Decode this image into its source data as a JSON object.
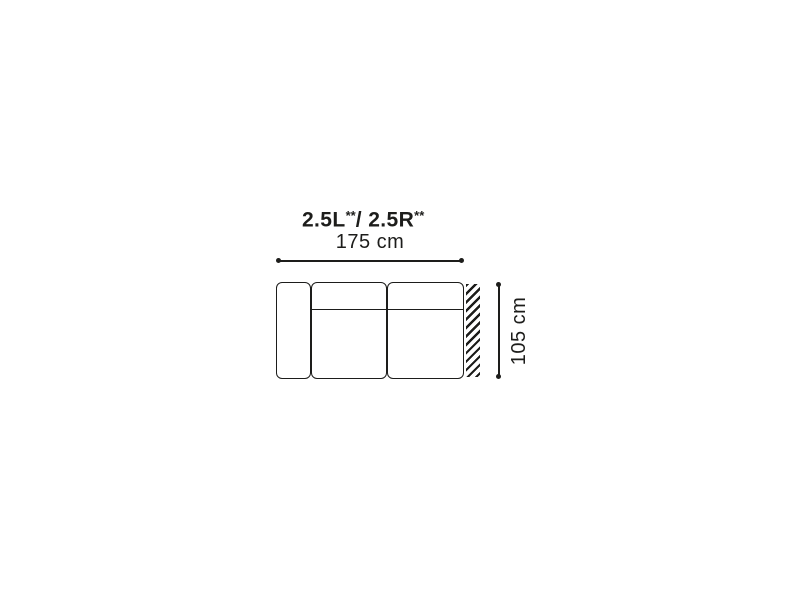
{
  "diagram": {
    "title": {
      "full_text": "2.5L**/ 2.5R**",
      "model_left": "2.5L",
      "model_left_mark": "**",
      "separator": "/ ",
      "model_right": "2.5R",
      "model_right_mark": "**"
    },
    "dimensions": {
      "width_label": "175 cm",
      "width_cm": 175,
      "depth_label": "105 cm",
      "depth_cm": 105
    },
    "sofa": {
      "view": "top",
      "parts": [
        "left-armrest",
        "seat-module-1",
        "seat-module-2",
        "open-end-hatch"
      ]
    },
    "colors": {
      "line": "#1d1d1b",
      "text": "#1d1d1b",
      "background": "#ffffff"
    }
  }
}
